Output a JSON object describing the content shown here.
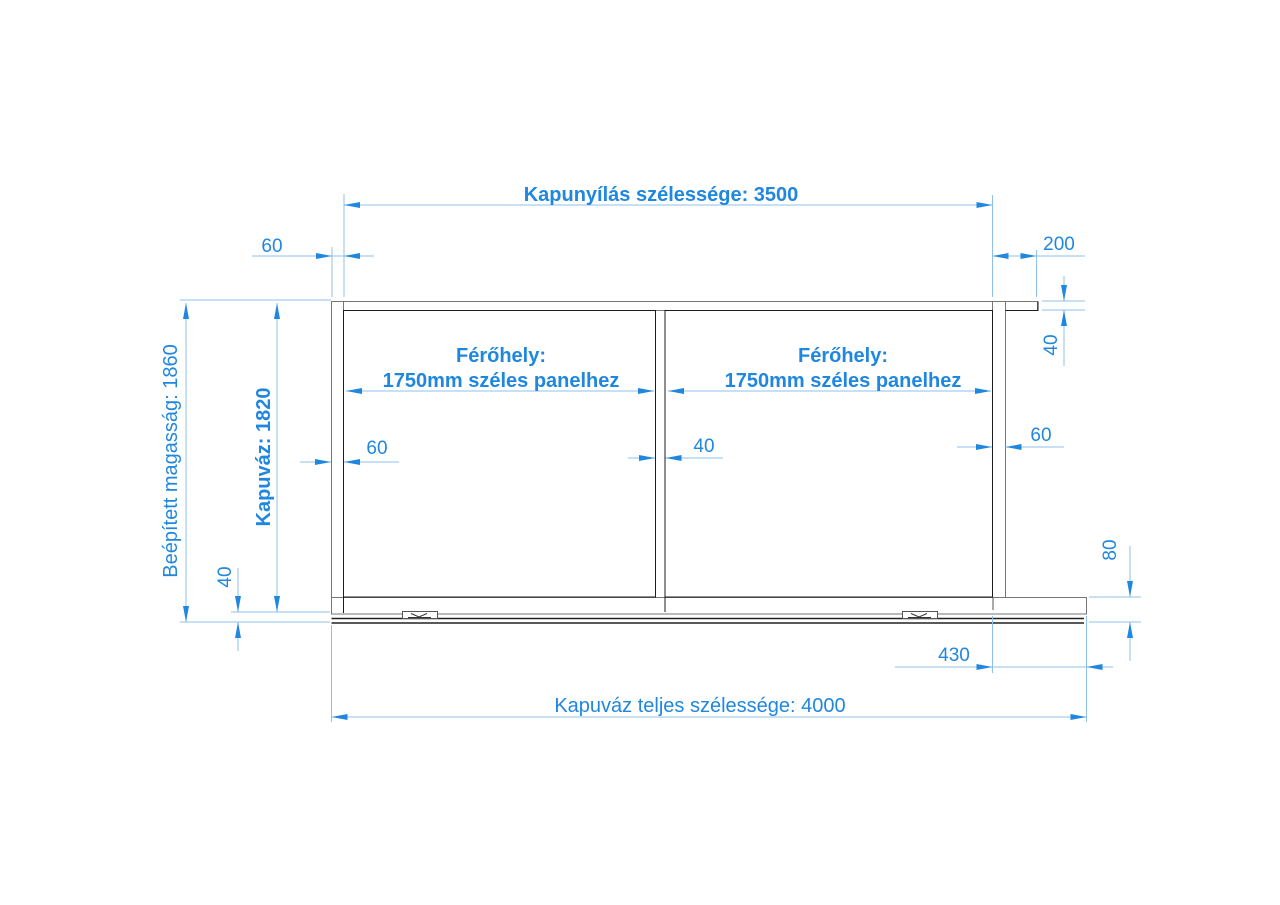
{
  "drawing": {
    "type": "technical-dimension-drawing",
    "subject": "sliding gate frame front view",
    "colors": {
      "dimension_blue": "#1f87e0",
      "dimension_line_blue": "#8fc0ee",
      "frame_gray": "#767676",
      "frame_dark": "#1c1c1c",
      "track_dark": "#222222",
      "background": "#ffffff"
    },
    "labels": {
      "gate_opening_width": "Kapunyílás szélessége: 3500",
      "frame_total_width": "Kapuváz teljes szélessége: 4000",
      "installed_height": "Beépített magasság: 1860",
      "frame_height": "Kapuváz: 1820",
      "post_width_top_left": "60",
      "rail_overhang_right": "200",
      "rail_thickness_right": "40",
      "post_width_mid_left": "60",
      "middle_post_width": "40",
      "post_width_mid_right": "60",
      "bottom_clearance_left": "40",
      "bottom_rail_height_right": "80",
      "bottom_overhang_right": "430",
      "panel_left_line1": "Férőhely:",
      "panel_left_line2": "1750mm széles panelhez",
      "panel_right_line1": "Férőhely:",
      "panel_right_line2": "1750mm széles panelhez"
    }
  }
}
